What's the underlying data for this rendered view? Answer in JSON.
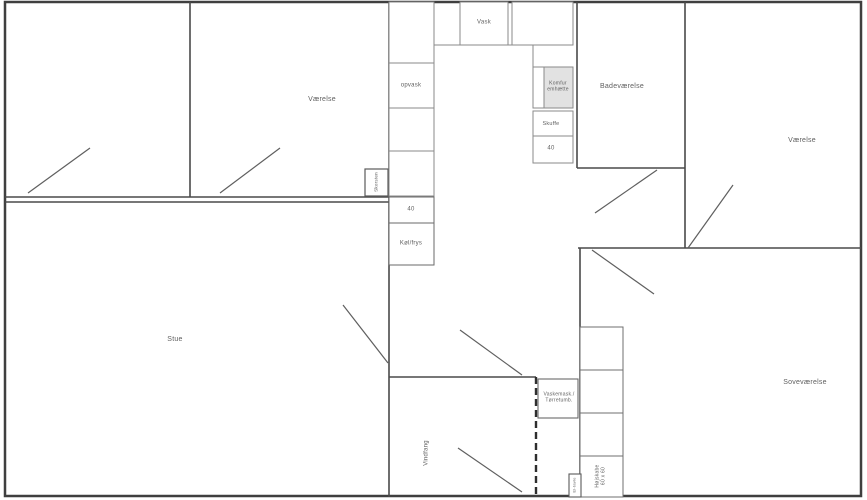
{
  "floorplan": {
    "rooms": {
      "vaerelse_left": "Værelse",
      "vaerelse_right": "Værelse",
      "badevaerelse": "Badeværelse",
      "stue": "Stue",
      "sovevaerelse": "Soveværelse",
      "vindfang": "Vindfang"
    },
    "kitchen": {
      "vask": "Vask",
      "opvask": "opvask",
      "size_40_left": "40",
      "size_40_right": "40",
      "koel_frys": "Køl/frys",
      "komfur": {
        "line1": "Komfur",
        "line2": "emhætte"
      },
      "skuffe": "Skuffe"
    },
    "fixtures": {
      "skorsten": "Skorsten",
      "el_tavle": "El-tavle",
      "vaskemask": {
        "line1": "Vaskemask./",
        "line2": "Tørretumb."
      },
      "hoejskabe": {
        "line1": "Højskabe",
        "line2": "60 x 60"
      }
    },
    "colors": {
      "wall": "#3f3f3f",
      "interior_wall": "#4a4a4a",
      "cell_line": "#8a8a8a",
      "appliance_fill": "#e2e2e2",
      "label_text": "#5f5f5f",
      "background": "#ffffff"
    }
  }
}
